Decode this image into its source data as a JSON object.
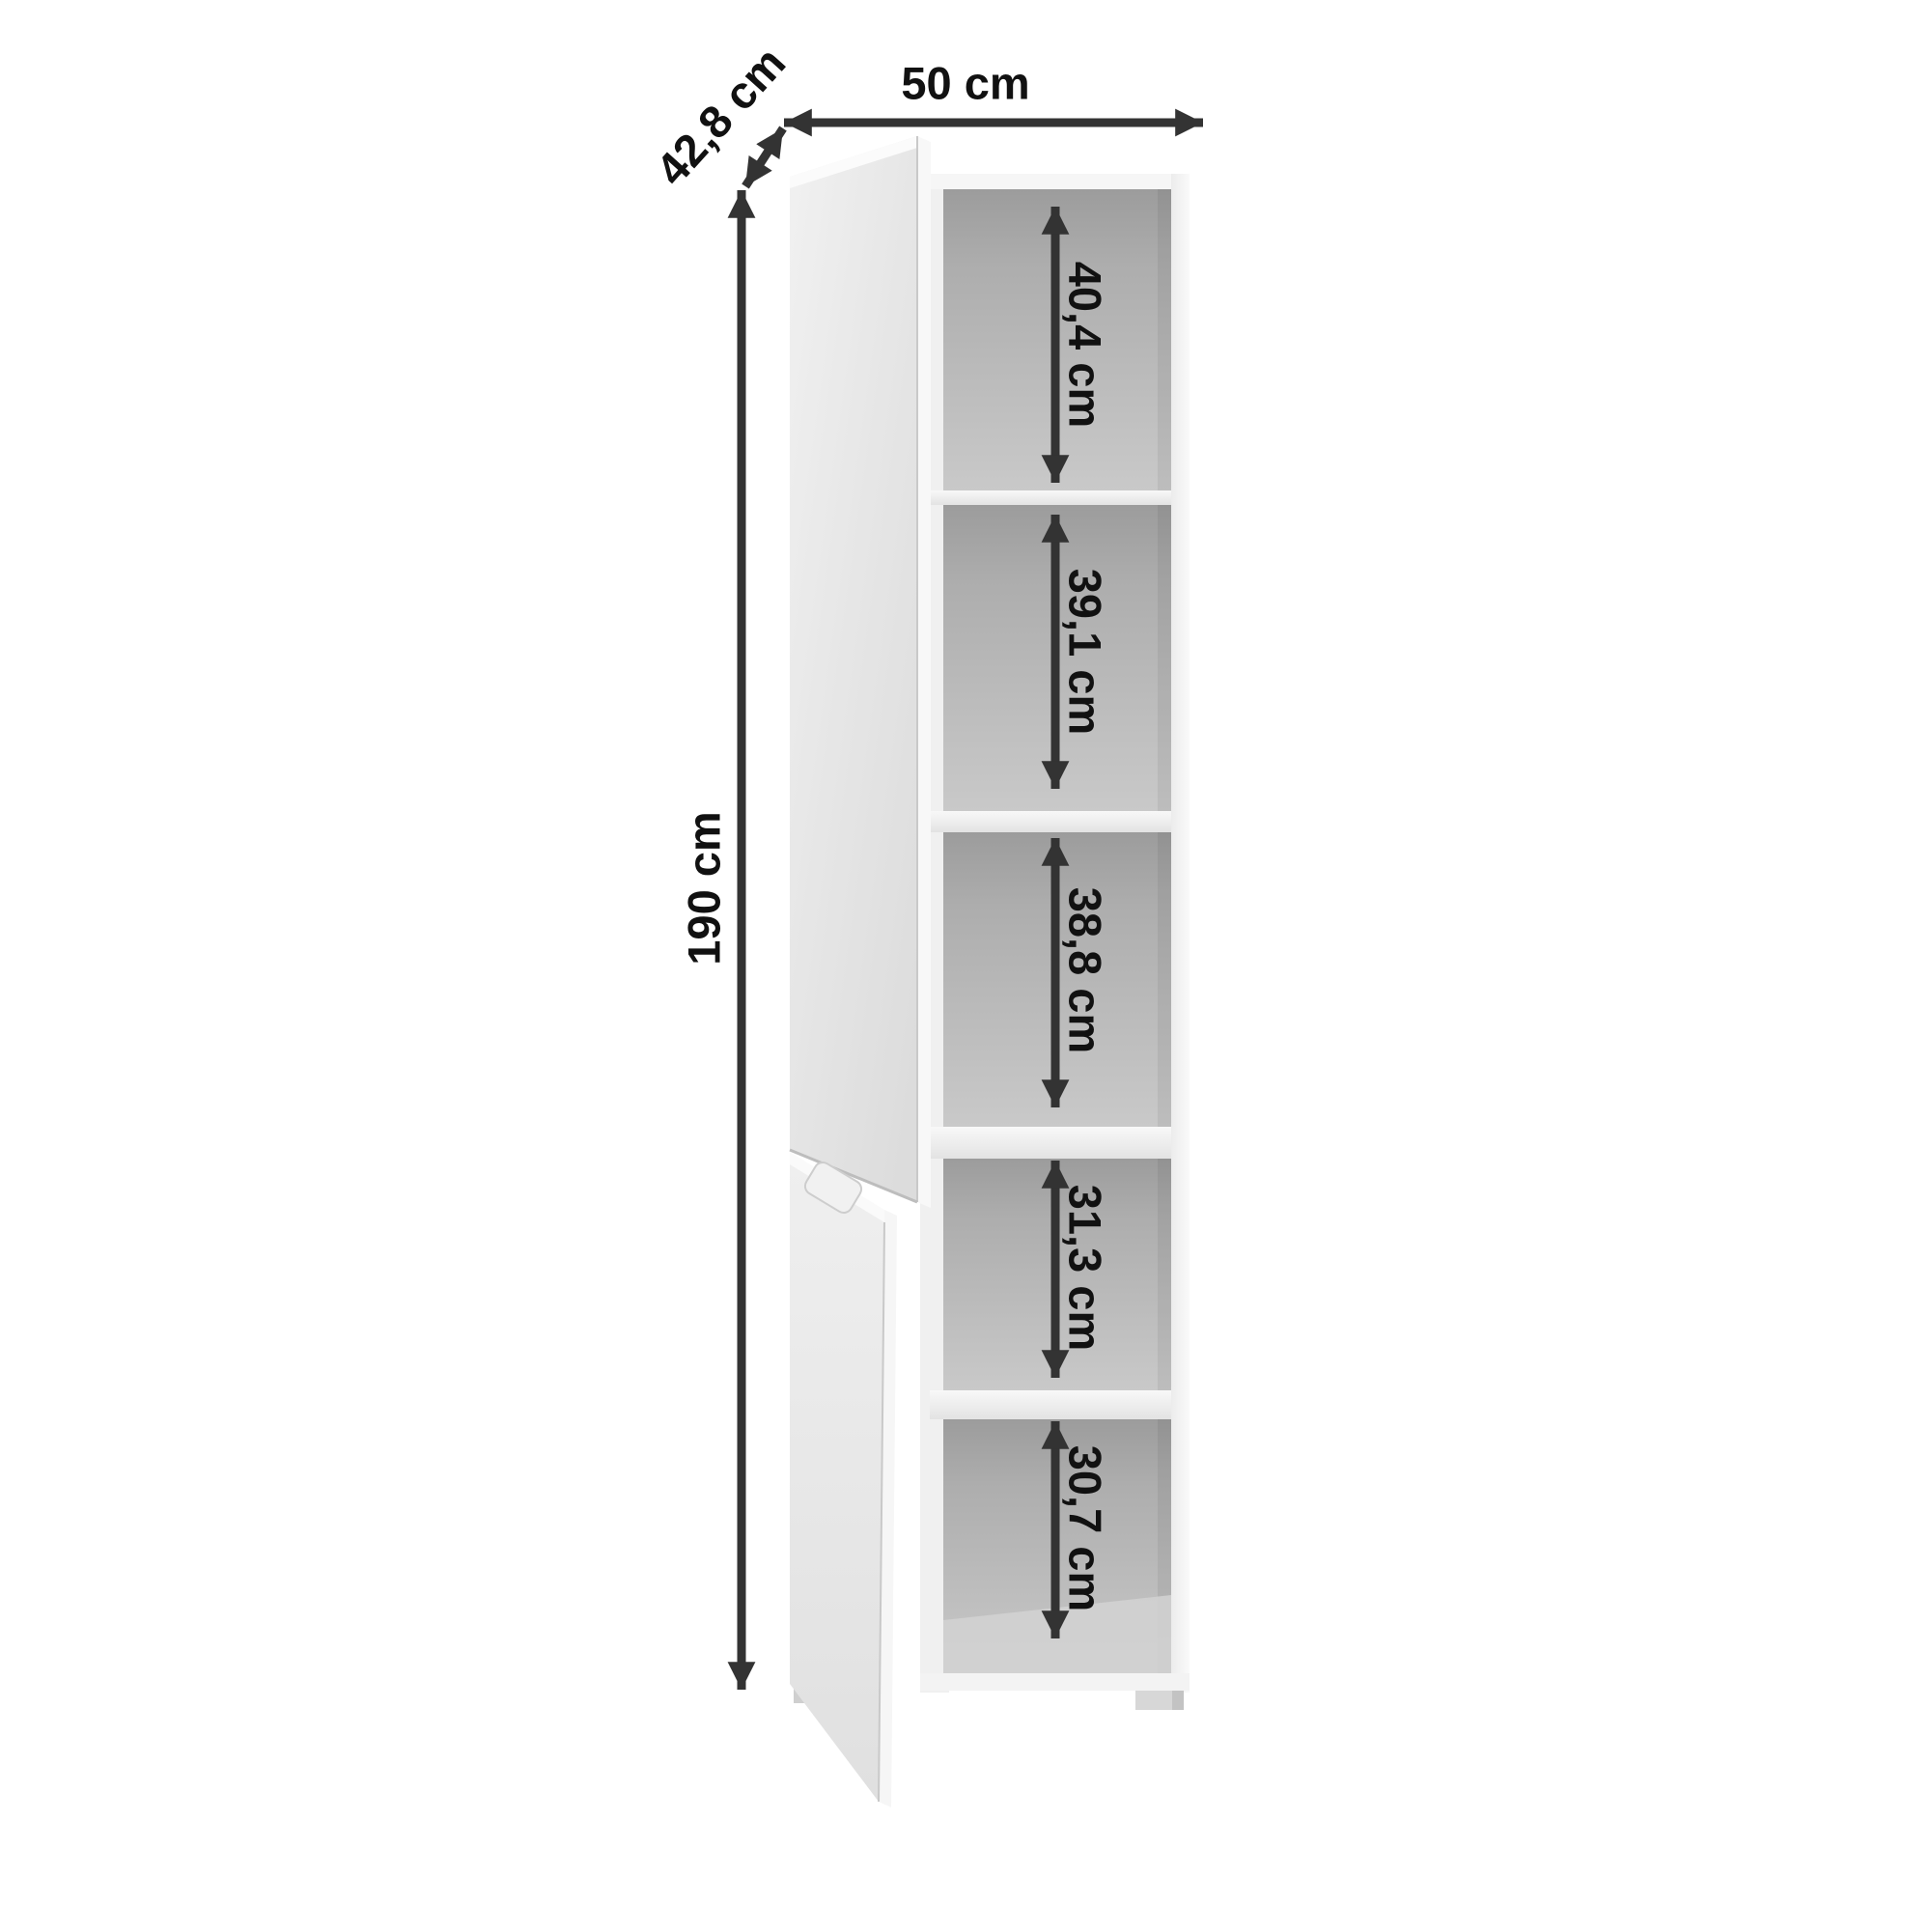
{
  "image": {
    "type": "furniture-dimension-diagram",
    "subject": "tall two-door cabinet with five open shelf compartments"
  },
  "dimensions": {
    "width": {
      "label": "50 cm"
    },
    "depth": {
      "label": "42,8 cm"
    },
    "height": {
      "label": "190 cm"
    }
  },
  "compartments": [
    {
      "name": "compartment-1",
      "label": "40,4 cm"
    },
    {
      "name": "compartment-2",
      "label": "39,1 cm"
    },
    {
      "name": "compartment-3",
      "label": "38,8 cm"
    },
    {
      "name": "compartment-4",
      "label": "31,3 cm"
    },
    {
      "name": "compartment-5",
      "label": "30,7 cm"
    }
  ],
  "style": {
    "background": "#ffffff",
    "arrow_color": "#333333",
    "text_color": "#111111",
    "door_light": "#f1f1f1",
    "door_dark": "#dcdcdc",
    "frame_color": "#f5f5f5",
    "interior_dark": "#9c9c9c",
    "interior_light": "#c9c9c9"
  }
}
